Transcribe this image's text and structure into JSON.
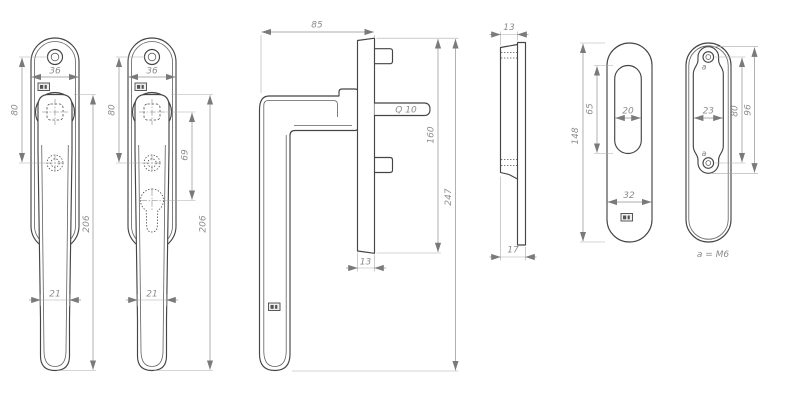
{
  "drawing": {
    "type": "technical-dimension-drawing",
    "subject": "window handle set with cover plates",
    "colors": {
      "line": "#454545",
      "dimension": "#909090",
      "text": "#8c8c8c",
      "background": "#ffffff"
    },
    "views": {
      "handle_front_plain": {
        "label": "handle front view (plain)",
        "plate_width": "36",
        "hole_spacing": "80",
        "length": "206",
        "grip_width": "21"
      },
      "handle_front_cylinder": {
        "label": "handle front view (key cylinder)",
        "plate_width": "36",
        "hole_spacing": "80",
        "cylinder_distance": "69",
        "length": "206",
        "grip_width": "21"
      },
      "handle_side": {
        "label": "handle side view",
        "projection": "85",
        "spindle_label": "Q 10",
        "plate_height": "160",
        "total_height": "247",
        "plate_width": "13"
      },
      "plate_edge": {
        "label": "cover plate edge view",
        "cover_thickness": "13",
        "total_thickness": "17"
      },
      "plate_front": {
        "label": "cover plate front view",
        "height": "148",
        "slot_height": "65",
        "slot_width": "20",
        "width": "32"
      },
      "plate_back": {
        "label": "cover plate back view",
        "insert_width": "23",
        "hole_spacing": "80",
        "insert_height": "96",
        "hole_label": "a",
        "note": "a = M6"
      }
    }
  }
}
